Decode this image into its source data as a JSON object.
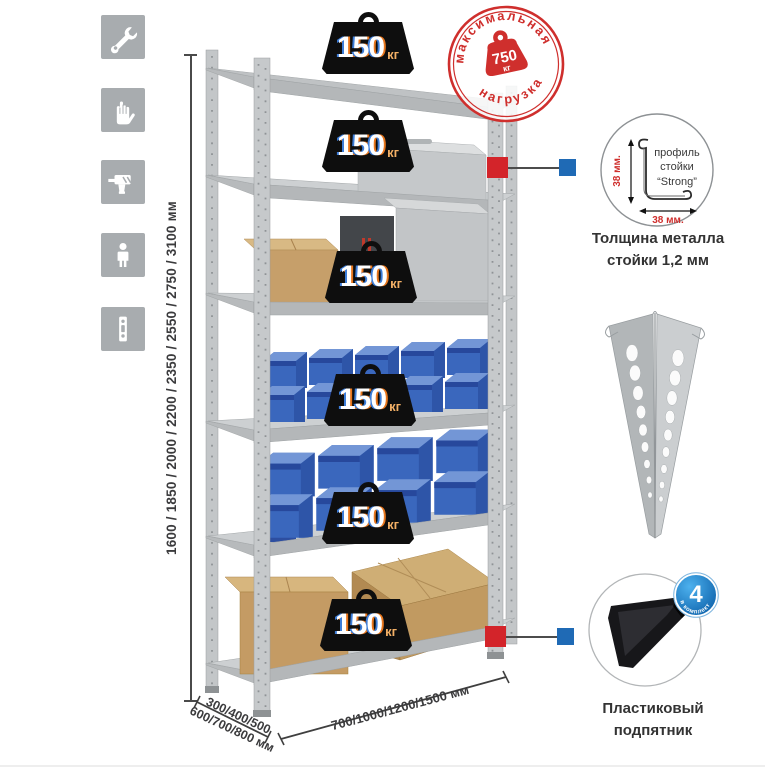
{
  "sidebar": {
    "icons": [
      {
        "name": "wrench"
      },
      {
        "name": "gloves"
      },
      {
        "name": "drill"
      },
      {
        "name": "person"
      },
      {
        "name": "perforated-post"
      }
    ]
  },
  "dimensions": {
    "height": "1600 / 1850 / 2000 / 2200 / 2350 / 2550 / 2750 / 3100 мм",
    "depth_line1": "300/400/500",
    "depth_line2": "600/700/800 мм",
    "width": "700/1000/1200/1500 мм"
  },
  "rack": {
    "shelves": [
      {
        "load_value": "150",
        "load_unit": "кг"
      },
      {
        "load_value": "150",
        "load_unit": "кг"
      },
      {
        "load_value": "150",
        "load_unit": "кг"
      },
      {
        "load_value": "150",
        "load_unit": "кг"
      },
      {
        "load_value": "150",
        "load_unit": "кг"
      },
      {
        "load_value": "150",
        "load_unit": "кг"
      }
    ]
  },
  "max_load_stamp": {
    "arc_top": "максимальная",
    "arc_bottom": "нагрузка",
    "value": "750",
    "unit": "кг"
  },
  "profile_detail": {
    "line1": "профиль",
    "line2": "стойки",
    "line3": "“Strong”",
    "vertical_dim": "38 мм.",
    "horizontal_dim": "38 мм.",
    "caption_line1": "Толщина металла",
    "caption_line2": "стойки 1,2 мм"
  },
  "foot_detail": {
    "badge_count": "4",
    "badge_label": "в комплекте",
    "caption_line1": "Пластиковый",
    "caption_line2": "подпятник"
  },
  "colors": {
    "accent_red": "#d3242a",
    "accent_blue": "#1f6ab5",
    "badge_black": "#0e0e0e",
    "bin_blue": "#3a67bd"
  }
}
